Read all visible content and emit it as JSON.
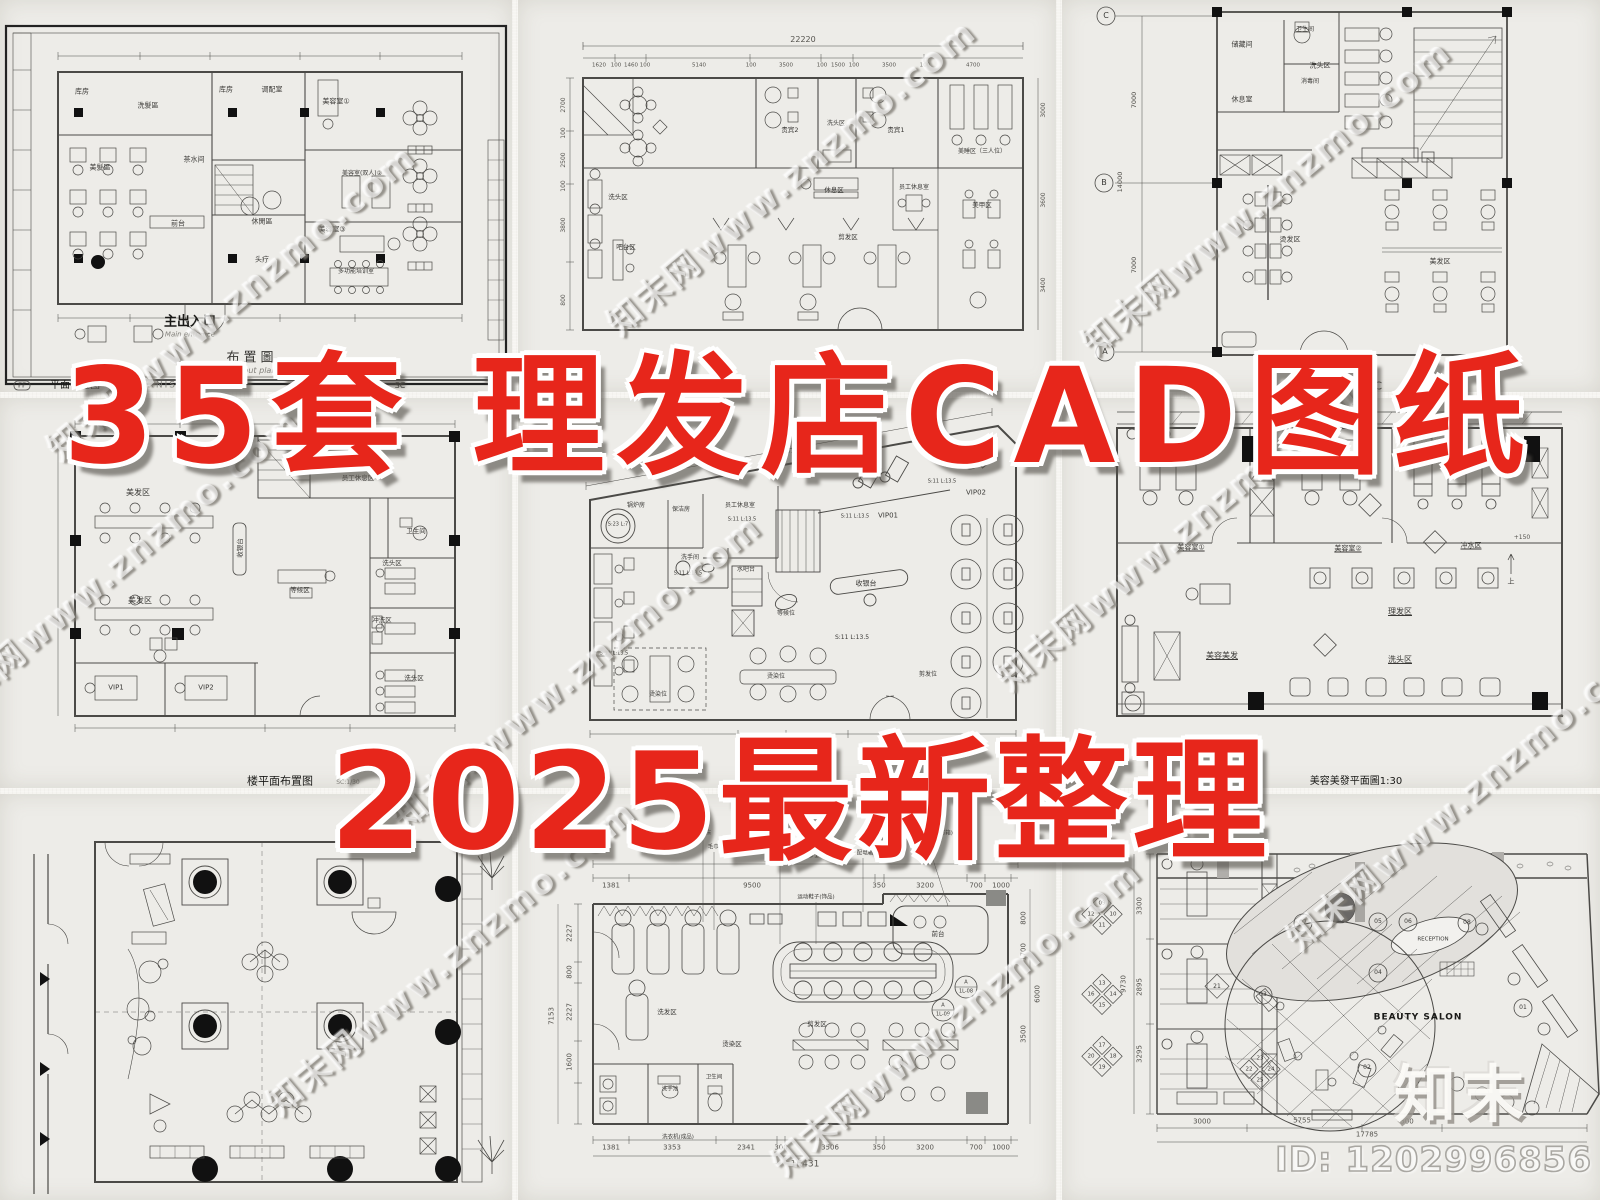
{
  "overlay": {
    "title_line1": "35套 理发店CAD图纸",
    "title_line2": "2025最新整理",
    "title_color": "#e7261b"
  },
  "brand": {
    "watermark": "知末网www.znzmo.com",
    "logo": "知末",
    "id_text": "ID: 1202996856"
  },
  "panels": {
    "p1": {
      "rooms": [
        "库房",
        "洗髮區",
        "库房",
        "调配室",
        "美容室①",
        "美髮區",
        "茶水间",
        "美容室(双人)②",
        "前台",
        "休閒區",
        "美容室③",
        "头疗",
        "多功能培训室"
      ],
      "entrance": "主出入口",
      "entrance_en": "Main entrance",
      "plan_title": "布置圖",
      "plan_title_en": "layout plan",
      "tag": "FF",
      "caption": "平面布置图",
      "caption_en": "FURNISHING",
      "scale": "SC"
    },
    "p2": {
      "dim_total": "22220",
      "dims_top": [
        "1620",
        "100",
        "1460",
        "100",
        "5140",
        "100",
        "3500",
        "100",
        "1500",
        "100",
        "3500",
        "100",
        "4700"
      ],
      "dims_left": [
        "2700",
        "100",
        "2500",
        "100",
        "3800",
        "800"
      ],
      "dims_right": [
        "3000",
        "3600",
        "3400"
      ],
      "rooms": [
        "洗头区",
        "贵宾2",
        "洗头区",
        "贵宾1",
        "美睡区（三人位）",
        "休息区",
        "员工休息室",
        "美甲区",
        "吧台区",
        "剪发区"
      ]
    },
    "p3": {
      "axes": [
        "C",
        "B",
        "A"
      ],
      "dims_left": [
        "7000",
        "14000",
        "7000"
      ],
      "rooms": [
        "储藏间",
        "卫生间",
        "消毒间",
        "休息室",
        "洗头区",
        "烫发区",
        "美发区"
      ],
      "caption": "置图 SC"
    },
    "p4": {
      "rooms": [
        "美发区",
        "员工休息区",
        "卫生间",
        "收银台",
        "洗头区",
        "等候区",
        "美发区",
        "冲洗区",
        "洗头区",
        "VIP1",
        "VIP2"
      ],
      "caption": "楼平面布置图",
      "scale": "SC:1/30"
    },
    "p5": {
      "dim_top": "14510",
      "stats": [
        "S:23 L:7",
        "S:11 L:13.5",
        "S:11 L:13.5",
        "S:11 L:13.5",
        "S:11 L:13.5",
        "S:11 L:13.5",
        "S:11 L:13.5"
      ],
      "rooms": [
        "锅炉房",
        "保洁房",
        "员工休息室",
        "洗手间",
        "水吧台",
        "等候位",
        "收银台",
        "烫染位",
        "烫染位",
        "剪发位",
        "VIP01",
        "VIP02"
      ],
      "dims_bottom": [
        "755",
        "720"
      ]
    },
    "p6": {
      "rooms": [
        "美容室①",
        "美容室②",
        "冲水区",
        "理发区",
        "美容美发",
        "洗头区"
      ],
      "level": "+150",
      "up": "上",
      "caption": "美容美發平面圖1:30"
    },
    "p8": {
      "dim_total": "16431",
      "dims_top": [
        "1381",
        "9500",
        "350",
        "3200",
        "700",
        "1000"
      ],
      "dims_left": [
        "7153",
        "2227",
        "800",
        "2227",
        "1600"
      ],
      "dims_right": [
        "800",
        "1700",
        "6000",
        "3500"
      ],
      "dims_bottom": [
        "1381",
        "3353",
        "2341",
        "300",
        "3506",
        "350",
        "3200",
        "700",
        "1000"
      ],
      "dim_total_bottom": "16431",
      "notes": [
        "洗发床",
        "毛巾机",
        "1200mm高隔断",
        "配电箱",
        "白色乳胶漆(包窗帘箱)",
        "运动鞋子(饰品)"
      ],
      "rooms": [
        "洗发区",
        "烫染区",
        "剪发区",
        "前台",
        "洗手池",
        "卫生间",
        "洗衣机(成品)"
      ],
      "callouts": [
        "A",
        "1L-08",
        "A",
        "1L-09"
      ]
    },
    "p9": {
      "salon": "BEAUTY SALON",
      "reception": "RECEPTION",
      "dims_left": [
        "3300",
        "9730",
        "2895",
        "3295"
      ],
      "dims_bottom": [
        "3000",
        "5755",
        "500",
        "17785"
      ],
      "circles": [
        "01",
        "02",
        "03",
        "04",
        "05",
        "06",
        "07",
        "08"
      ],
      "d21": "21",
      "cluster1": [
        "09",
        "12",
        "10",
        "11"
      ],
      "cluster2": [
        "13",
        "16",
        "14",
        "15"
      ],
      "cluster3": [
        "17",
        "20",
        "18",
        "19"
      ],
      "cluster4": [
        "23",
        "22",
        "24",
        "25"
      ]
    }
  }
}
